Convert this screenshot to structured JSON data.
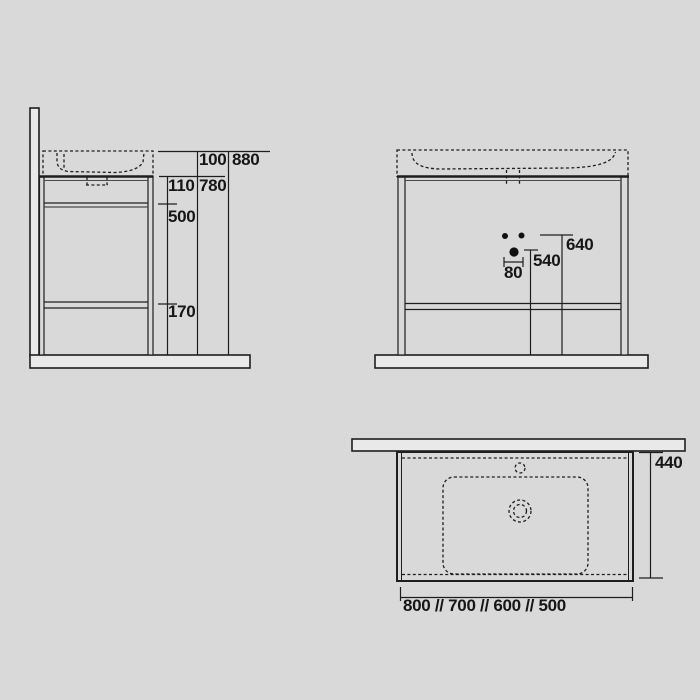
{
  "dims": {
    "side_basin_height": "100",
    "side_total_height": "880",
    "side_top_section": "110",
    "side_frame_height": "780",
    "side_mid_section": "500",
    "side_bottom_section": "170",
    "front_upper_holes_height": "640",
    "front_center_hole_height": "540",
    "front_hole_spacing": "80",
    "plan_depth": "440",
    "plan_available_widths": "800 // 700 // 600 // 500"
  },
  "colors": {
    "background": "#d9d9d9",
    "panel_fill": "#e9e9e9",
    "line": "#1e1e1e",
    "text": "#161616"
  }
}
